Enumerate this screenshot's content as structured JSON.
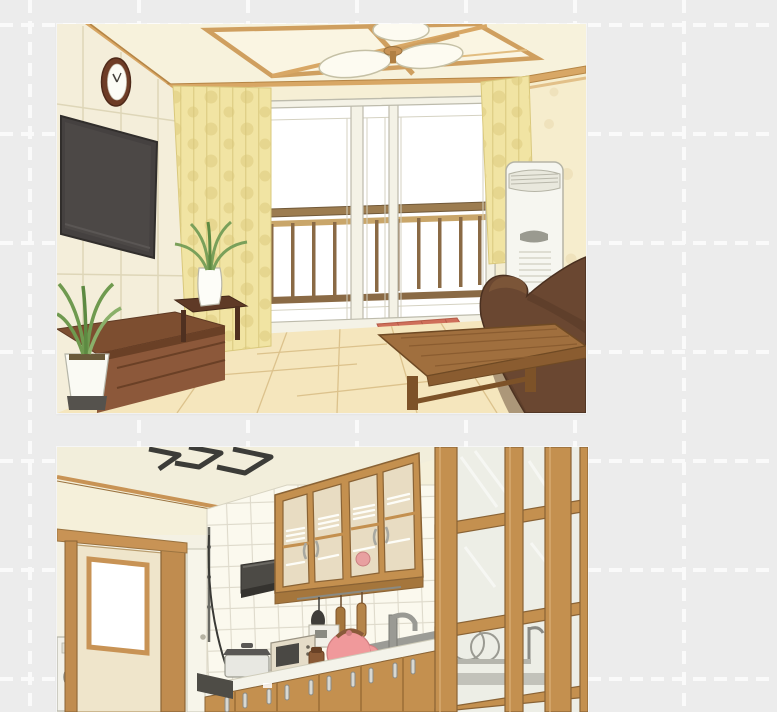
{
  "canvas": {
    "background_color": "#ececec",
    "grid": {
      "line_color": "#fafafa",
      "spacing_px": 109,
      "x_offset_px": 30,
      "y_offset_px": 25,
      "dash_px": 13,
      "gap_px": 8,
      "thickness_px": 4
    }
  },
  "images": [
    {
      "name": "living-room-illustration",
      "alt": "Illustrated living room with wall clock, wall-mounted TV, yellow polka-dot curtains, balcony sliding glass doors with railing, floor air conditioner, brown sofa and wooden coffee table",
      "x": 57,
      "y": 24,
      "width": 529,
      "height": 389,
      "objects": [
        "wall-clock",
        "wall-mounted-tv",
        "wall-panels",
        "ceiling-lamp",
        "wood-ceiling-trim",
        "yellow-polka-dot-curtains",
        "balcony-sliding-doors",
        "balcony-railing",
        "red-doormat",
        "floor-air-conditioner",
        "brown-sofa",
        "wooden-coffee-table",
        "tv-sideboard",
        "side-table-with-vase-plant",
        "corner-potted-plant",
        "wood-plank-floor",
        "floral-right-wall"
      ],
      "palette": {
        "wall": "#f5efd9",
        "ceiling": "#f7f2dd",
        "wood_trim": "#d6a666",
        "curtain": "#f1e4a3",
        "curtain_dot": "#e3d289",
        "glass": "#ffffff",
        "railing": "#9c7c50",
        "sofa": "#6a4731",
        "coffee_table": "#a06f3e",
        "floor": "#f5e6bd",
        "tv": "#454140",
        "clock_frame": "#6e3c26",
        "air_conditioner": "#f6f6f0",
        "doormat": "#cf6f5a"
      }
    },
    {
      "name": "kitchen-illustration",
      "alt": "Illustrated kitchen with black ceiling light frame, wooden sliding door, washing machine, tiled wall, range hood, glass-front upper cabinets with dishes, counter appliances including pink kettle and toaster oven, wooden lower cabinets and a glass-paned wooden partition",
      "x": 57,
      "y": 447,
      "width": 531,
      "height": 265,
      "objects": [
        "ceiling-light-frame",
        "sliding-door-with-window",
        "washing-machine",
        "white-interior-door",
        "tiled-wall",
        "range-hood",
        "glass-front-upper-cabinets",
        "hanging-utensils",
        "stock-pot",
        "toaster-oven",
        "pink-kettle",
        "spice-grinder",
        "sink-and-faucet",
        "white-countertop",
        "wooden-lower-cabinets-with-handles",
        "glass-paned-partition",
        "dish-rack-behind-glass"
      ],
      "palette": {
        "ceiling": "#f2eedb",
        "wood": "#c4904f",
        "wood_dark": "#a5763c",
        "tile": "#fbf9ee",
        "grout": "#dedacb",
        "hood": "#4c4a45",
        "counter": "#f4f3ea",
        "kettle": "#f0999b",
        "steel_handle": "#d8d8d2",
        "light_frame": "#3c3c38",
        "partition_glass": "#edeee6"
      }
    }
  ]
}
